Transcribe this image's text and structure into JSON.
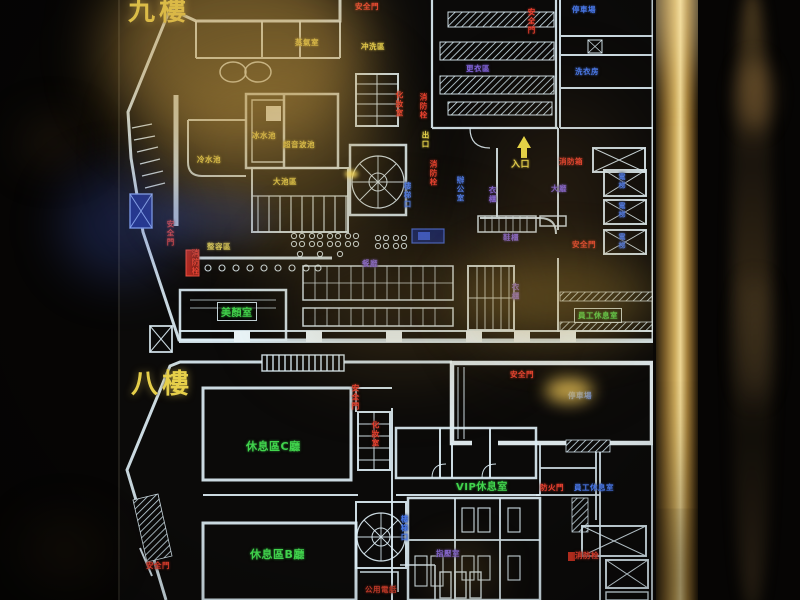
{
  "sign": {
    "floors": [
      {
        "name": "九樓",
        "labels": [
          {
            "text": "安全門",
            "color": "red",
            "x": 355,
            "y": 1
          },
          {
            "text": "安全門",
            "color": "red",
            "x": 526,
            "y": 8,
            "vertical": true
          },
          {
            "text": "蒸氣室",
            "color": "yellow",
            "x": 295,
            "y": 37
          },
          {
            "text": "冲洗區",
            "color": "yellow",
            "x": 361,
            "y": 41
          },
          {
            "text": "停車場",
            "color": "blue",
            "x": 572,
            "y": 4
          },
          {
            "text": "洗衣房",
            "color": "blue",
            "x": 575,
            "y": 66
          },
          {
            "text": "更衣區",
            "color": "purple",
            "x": 466,
            "y": 63
          },
          {
            "text": "冷水池",
            "color": "yellow",
            "x": 197,
            "y": 154
          },
          {
            "text": "冰水池",
            "color": "yellow",
            "x": 252,
            "y": 130
          },
          {
            "text": "超音波池",
            "color": "yellow",
            "x": 283,
            "y": 139
          },
          {
            "text": "大池區",
            "color": "yellow",
            "x": 273,
            "y": 176
          },
          {
            "text": "化妝室",
            "color": "red",
            "x": 394,
            "y": 91,
            "vertical": true
          },
          {
            "text": "消防栓",
            "color": "red",
            "x": 418,
            "y": 93,
            "vertical": true
          },
          {
            "text": "出口",
            "color": "yellow",
            "x": 420,
            "y": 131,
            "vertical": true
          },
          {
            "text": "消防栓",
            "color": "red",
            "x": 428,
            "y": 160,
            "vertical": true
          },
          {
            "text": "樓梯口",
            "color": "blue",
            "x": 402,
            "y": 182,
            "vertical": true
          },
          {
            "text": "辦公室",
            "color": "blue",
            "x": 455,
            "y": 176,
            "vertical": true
          },
          {
            "text": "衣櫃",
            "color": "purple",
            "x": 487,
            "y": 186,
            "vertical": true
          },
          {
            "text": "入口",
            "color": "yellow",
            "x": 511,
            "y": 157,
            "size": 9
          },
          {
            "text": "消防箱",
            "color": "red",
            "x": 559,
            "y": 156
          },
          {
            "text": "大廳",
            "color": "purple",
            "x": 551,
            "y": 183
          },
          {
            "text": "電梯",
            "color": "blue",
            "x": 617,
            "y": 173,
            "vertical": true,
            "size": 7
          },
          {
            "text": "電梯",
            "color": "blue",
            "x": 617,
            "y": 202,
            "vertical": true,
            "size": 7
          },
          {
            "text": "電梯",
            "color": "blue",
            "x": 617,
            "y": 233,
            "vertical": true,
            "size": 7
          },
          {
            "text": "鞋櫃",
            "color": "purple",
            "x": 503,
            "y": 232
          },
          {
            "text": "安全門",
            "color": "red",
            "x": 572,
            "y": 239
          },
          {
            "text": "衣櫃",
            "color": "purple",
            "x": 510,
            "y": 283,
            "vertical": true
          },
          {
            "text": "員工休息室",
            "color": "green",
            "x": 574,
            "y": 308,
            "boxed": true
          },
          {
            "text": "安全門",
            "color": "red",
            "x": 165,
            "y": 220,
            "vertical": true
          },
          {
            "text": "整容區",
            "color": "yellow",
            "x": 207,
            "y": 241
          },
          {
            "text": "消防栓",
            "color": "red",
            "x": 190,
            "y": 249,
            "vertical": true
          },
          {
            "text": "美顏室",
            "color": "green",
            "x": 217,
            "y": 302,
            "boxed": true,
            "size": 10
          },
          {
            "text": "餐廳",
            "color": "purple",
            "x": 362,
            "y": 258
          }
        ]
      },
      {
        "name": "八樓",
        "labels": [
          {
            "text": "安全門",
            "color": "red",
            "x": 350,
            "y": 384,
            "vertical": true
          },
          {
            "text": "安全門",
            "color": "red",
            "x": 510,
            "y": 369
          },
          {
            "text": "停車場",
            "color": "blue",
            "x": 568,
            "y": 390
          },
          {
            "text": "化妝室",
            "color": "red",
            "x": 370,
            "y": 421,
            "vertical": true
          },
          {
            "text": "休息區C廳",
            "color": "green",
            "x": 246,
            "y": 438,
            "size": 11
          },
          {
            "text": "VIP休息室",
            "color": "green",
            "x": 456,
            "y": 478,
            "size": 10
          },
          {
            "text": "防火門",
            "color": "red",
            "x": 540,
            "y": 482
          },
          {
            "text": "員工休息室",
            "color": "blue",
            "x": 574,
            "y": 482
          },
          {
            "text": "樓梯口",
            "color": "blue",
            "x": 399,
            "y": 515,
            "vertical": true
          },
          {
            "text": "休息區B廳",
            "color": "green",
            "x": 250,
            "y": 546,
            "size": 11
          },
          {
            "text": "指壓室",
            "color": "purple",
            "x": 436,
            "y": 548
          },
          {
            "text": "消防栓",
            "color": "red",
            "x": 575,
            "y": 550
          },
          {
            "text": "安全門",
            "color": "red",
            "x": 146,
            "y": 560
          },
          {
            "text": "公用電話",
            "color": "darkred",
            "x": 365,
            "y": 584
          }
        ]
      }
    ]
  },
  "palette": {
    "yellow": "#ecd94e",
    "red": "#ea4130",
    "green": "#41d44d",
    "blue": "#4a79ea",
    "purple": "#8264dc",
    "darkred": "#c23a28",
    "wall": "#dcedf4",
    "frame_gold": "#c9a85c",
    "sign_background": "#0b0a09"
  }
}
